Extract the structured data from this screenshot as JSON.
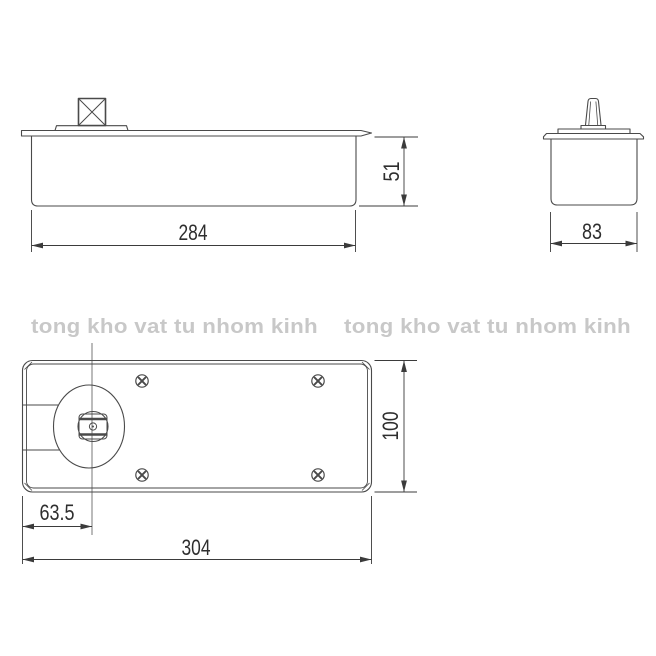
{
  "page": {
    "background": "#ffffff"
  },
  "watermark": {
    "color": "#c8c8c8",
    "instances": [
      {
        "text": "tong kho vat tu nhom kinh"
      },
      {
        "text": "tong kho vat tu nhom kinh"
      }
    ]
  },
  "drawing": {
    "line_color": "#4a4a4a",
    "dim_color": "#3b3b3b",
    "text_color": "#2e2e2e",
    "views": {
      "front": {
        "width_dim": "284",
        "height_dim": "51"
      },
      "end": {
        "width_dim": "83"
      },
      "plan": {
        "width_dim": "304",
        "height_dim": "100",
        "spindle_offset_dim": "63.5"
      }
    }
  }
}
